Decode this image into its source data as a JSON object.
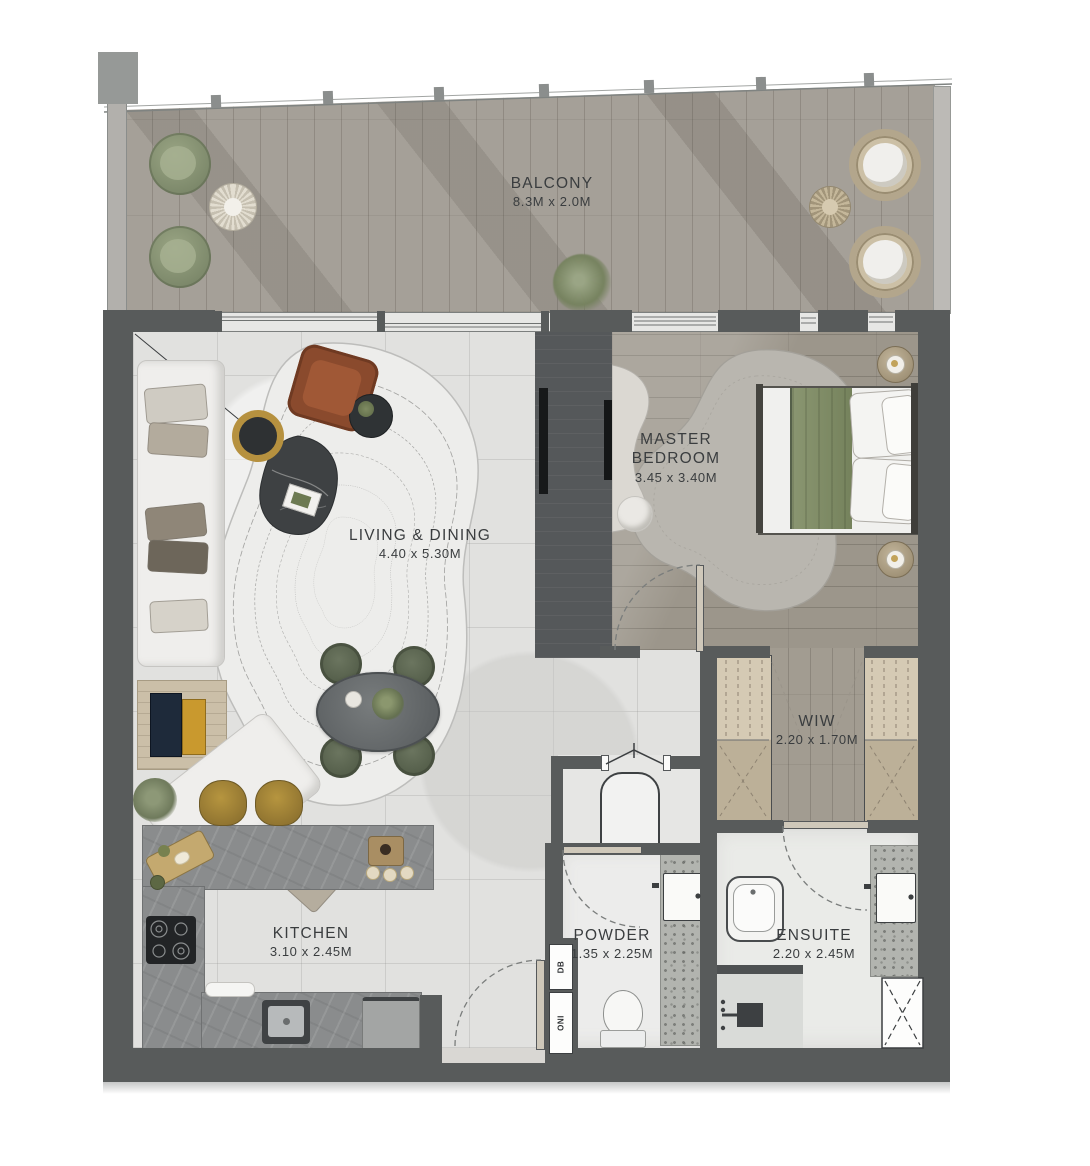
{
  "plan": {
    "balcony": {
      "name": "BALCONY",
      "dims": "8.3M x 2.0M"
    },
    "living": {
      "name": "LIVING & DINING",
      "dims": "4.40 x 5.30M"
    },
    "master": {
      "name": "MASTER BEDROOM",
      "dims": "3.45 x 3.40M"
    },
    "wiw": {
      "name": "WIW",
      "dims": "2.20 x 1.70M"
    },
    "kitchen": {
      "name": "KITCHEN",
      "dims": "3.10 x 2.45M"
    },
    "powder": {
      "name": "POWDER",
      "dims": "1.35 x 2.25M"
    },
    "ensuite": {
      "name": "ENSUITE",
      "dims": "2.20 x 2.45M"
    },
    "shafts": [
      {
        "label": "DB"
      },
      {
        "label": "ONI"
      }
    ],
    "colors": {
      "wall": "#585b5b",
      "balcony_wood": "#a5a098",
      "bedroom_wood": "#9c968b",
      "tile": "#e1e1df",
      "counter_marble": "#8a8c8d",
      "olive_green": "#8d9678",
      "stool_gold": "#ab8b40",
      "bed_green": "#7e8a64",
      "armchair_brown": "#8a4a2d",
      "label_text": "#3a3d3f"
    }
  }
}
